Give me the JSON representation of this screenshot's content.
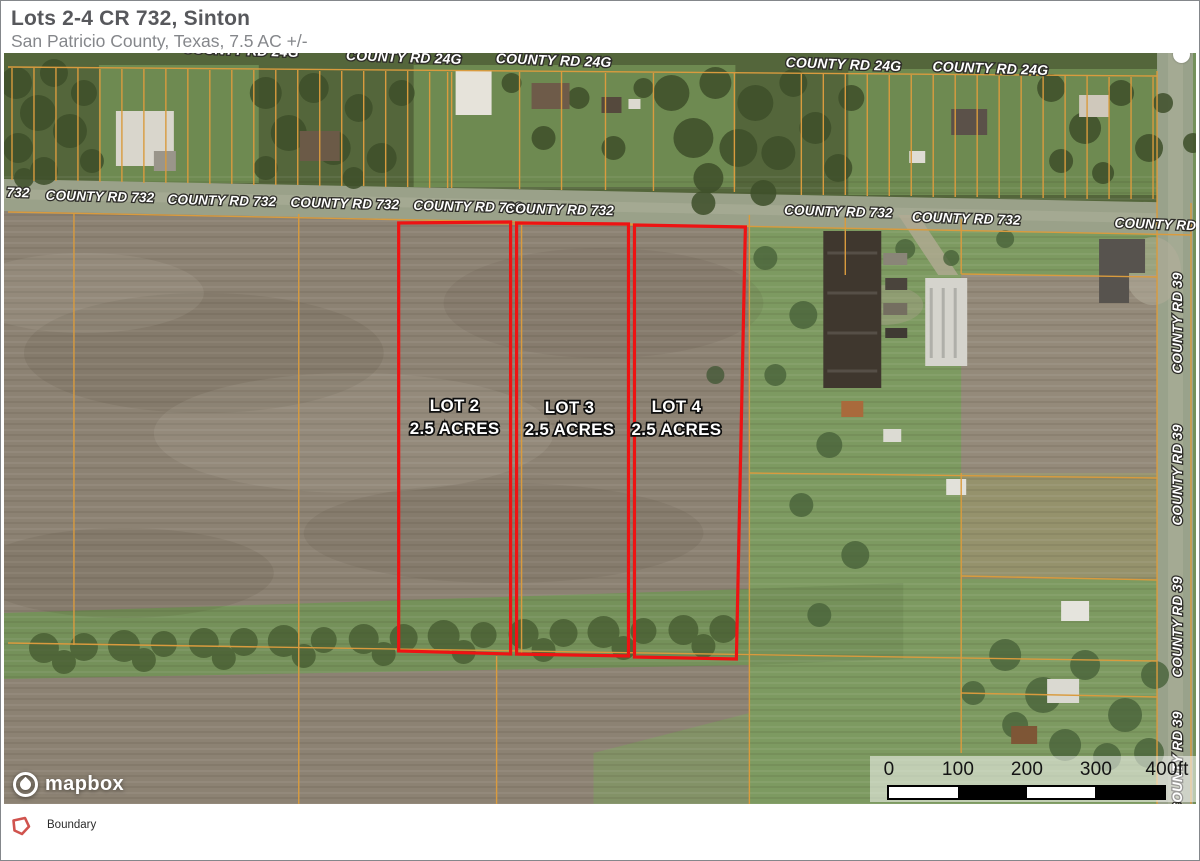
{
  "header": {
    "title": "Lots 2-4 CR 732, Sinton",
    "subtitle": "San Patricio County, Texas, 7.5 AC +/-"
  },
  "map": {
    "road_24g_labels": [
      "COUNTY RD 24G",
      "COUNTY RD 24G",
      "COUNTY RD 24G",
      "COUNTY RD 24G",
      "COUNTY RD 24G"
    ],
    "road_732_labels": [
      "732",
      "COUNTY RD 732",
      "COUNTY RD 732",
      "COUNTY RD 732",
      "COUNTY RD 732",
      "COUNTY RD 732",
      "COUNTY RD 732",
      "COUNTY RD 732",
      "COUNTY RD 7"
    ],
    "road_39_labels": [
      "COUNTY RD 39",
      "COUNTY RD 39",
      "COUNTY RD 39",
      "COUNTY RD 39"
    ],
    "lots": [
      {
        "name": "LOT 2",
        "area": "2.5 ACRES"
      },
      {
        "name": "LOT 3",
        "area": "2.5 ACRES"
      },
      {
        "name": "LOT 4",
        "area": "2.5 ACRES"
      }
    ],
    "attribution": "mapbox",
    "scale_bar": {
      "ticks": [
        "0",
        "100",
        "200",
        "300",
        "400ft"
      ]
    },
    "colors": {
      "boundary": "#ee1313",
      "parcel_line": "#d99b3e"
    }
  },
  "legend": {
    "items": [
      {
        "label": "Boundary",
        "color": "#d0534e"
      }
    ]
  }
}
